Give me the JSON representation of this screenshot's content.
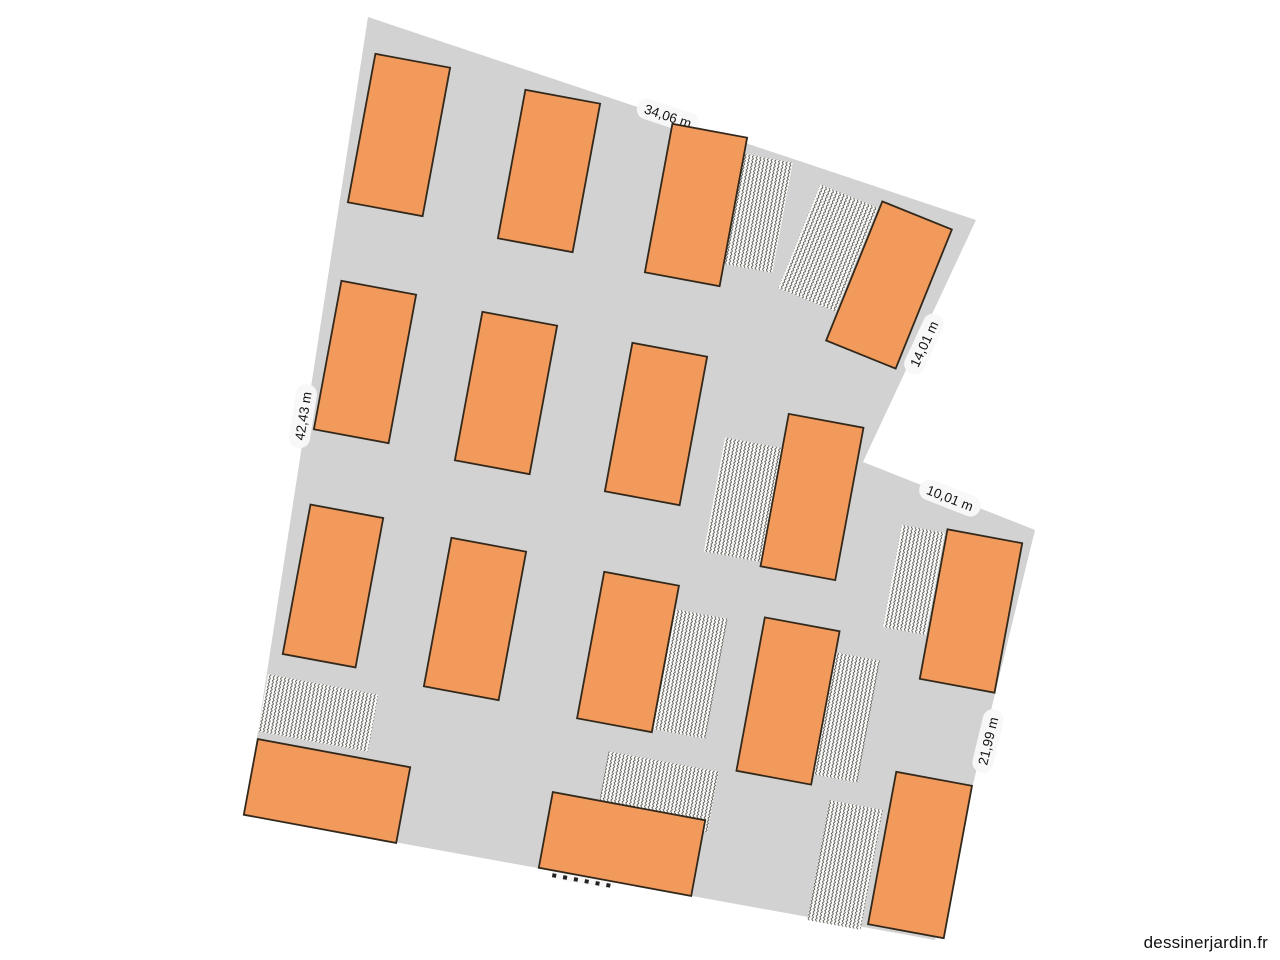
{
  "watermark": "dessinerjardin.fr",
  "colors": {
    "canvas_bg": "#ffffff",
    "plot_fill": "#d2d2d2",
    "bed_fill": "#f19a5b",
    "bed_border": "#33281c",
    "hatch_bg": "#fcfcfa",
    "hatch_line": "#3f3e39",
    "label_bg": "#f8f8f8",
    "label_text": "#141414"
  },
  "plan": {
    "plot_outline_px": [
      [
        368,
        17
      ],
      [
        976,
        220
      ],
      [
        863,
        462
      ],
      [
        1035,
        530
      ],
      [
        935,
        940
      ],
      [
        245,
        815
      ]
    ],
    "measurements": [
      {
        "text": "34,06 m",
        "x": 668,
        "y": 116,
        "angle": 18.5,
        "obscured": false
      },
      {
        "text": "14,01 m",
        "x": 924,
        "y": 344,
        "angle": -65,
        "obscured": false
      },
      {
        "text": "42,43 m",
        "x": 303,
        "y": 416,
        "angle": -81,
        "obscured": false
      },
      {
        "text": "10,01 m",
        "x": 950,
        "y": 498,
        "angle": 21.5,
        "obscured": false
      },
      {
        "text": "21,99 m",
        "x": 988,
        "y": 741,
        "angle": -76.5,
        "obscured": false
      },
      {
        "text": "",
        "x": 585,
        "y": 874,
        "angle": 10.3,
        "obscured": true
      }
    ],
    "beds": [
      {
        "x": 399,
        "y": 135,
        "w": 76,
        "h": 151,
        "angle": 10.5
      },
      {
        "x": 549,
        "y": 171,
        "w": 76,
        "h": 151,
        "angle": 10.5
      },
      {
        "x": 696,
        "y": 205,
        "w": 76,
        "h": 151,
        "angle": 10.5
      },
      {
        "x": 889,
        "y": 285,
        "w": 75,
        "h": 150,
        "angle": 22
      },
      {
        "x": 365,
        "y": 362,
        "w": 76,
        "h": 151,
        "angle": 10.5
      },
      {
        "x": 506,
        "y": 393,
        "w": 76,
        "h": 151,
        "angle": 10.5
      },
      {
        "x": 656,
        "y": 424,
        "w": 76,
        "h": 151,
        "angle": 10.5
      },
      {
        "x": 812,
        "y": 497,
        "w": 76,
        "h": 155,
        "angle": 10.5
      },
      {
        "x": 333,
        "y": 586,
        "w": 74,
        "h": 152,
        "angle": 10.5
      },
      {
        "x": 475,
        "y": 619,
        "w": 76,
        "h": 151,
        "angle": 10.5
      },
      {
        "x": 628,
        "y": 652,
        "w": 76,
        "h": 149,
        "angle": 10.5
      },
      {
        "x": 788,
        "y": 701,
        "w": 76,
        "h": 156,
        "angle": 10.5
      },
      {
        "x": 971,
        "y": 611,
        "w": 76,
        "h": 152,
        "angle": 10.5
      },
      {
        "x": 327,
        "y": 791,
        "w": 155,
        "h": 77,
        "angle": 10.5
      },
      {
        "x": 622,
        "y": 844,
        "w": 155,
        "h": 77,
        "angle": 10.5
      },
      {
        "x": 920,
        "y": 855,
        "w": 77,
        "h": 155,
        "angle": 10.5
      }
    ],
    "hatched_areas": [
      {
        "x": 751,
        "y": 212,
        "w": 64,
        "h": 112,
        "angle": 10.5
      },
      {
        "x": 828,
        "y": 248,
        "w": 62,
        "h": 112,
        "angle": 22
      },
      {
        "x": 744,
        "y": 500,
        "w": 60,
        "h": 116,
        "angle": 10.5
      },
      {
        "x": 685,
        "y": 673,
        "w": 64,
        "h": 122,
        "angle": 10.5
      },
      {
        "x": 844,
        "y": 717,
        "w": 50,
        "h": 124,
        "angle": 10.5
      },
      {
        "x": 914,
        "y": 580,
        "w": 44,
        "h": 104,
        "angle": 10.5
      },
      {
        "x": 318,
        "y": 713,
        "w": 112,
        "h": 58,
        "angle": 10.5
      },
      {
        "x": 658,
        "y": 792,
        "w": 112,
        "h": 62,
        "angle": 10.5
      },
      {
        "x": 845,
        "y": 865,
        "w": 54,
        "h": 122,
        "angle": 10.5
      }
    ]
  }
}
